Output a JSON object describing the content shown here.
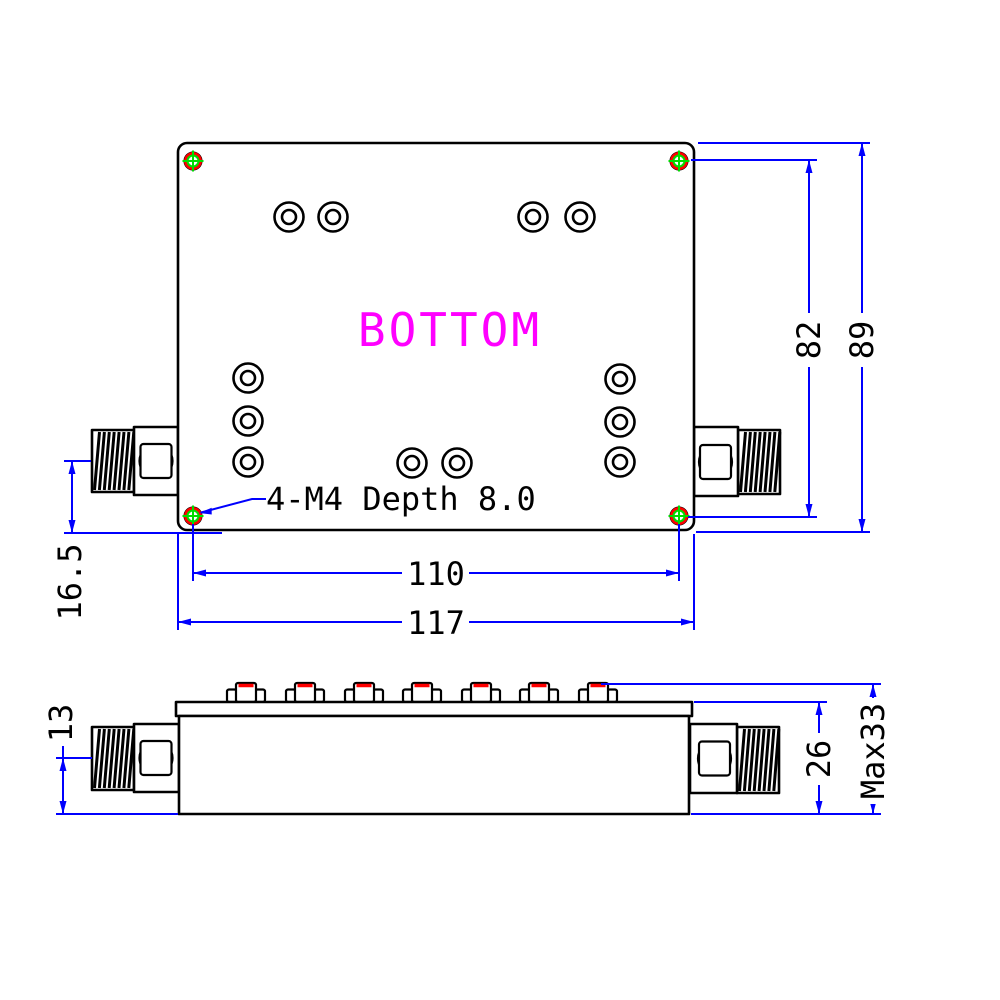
{
  "drawing_title": "RF module outline drawing",
  "bottom_view": {
    "label": "BOTTOM",
    "screw_note": "4-M4 Depth 8.0",
    "dim_hole_span_v": "82",
    "dim_overall_height": "89",
    "dim_hole_span_h": "110",
    "dim_overall_width": "117",
    "dim_connector_to_edge": "16.5"
  },
  "side_view": {
    "dim_connector_center": "13",
    "dim_body_height": "26",
    "dim_max_height": "Max33"
  },
  "colors": {
    "outline": "#000000",
    "dimension_blue": "#0000fe",
    "label_magenta": "#ff00ff",
    "corner_marker_red": "#ff0000",
    "corner_marker_green": "#00dd00",
    "screw_top_red": "#ff0000",
    "background": "#ffffff"
  }
}
